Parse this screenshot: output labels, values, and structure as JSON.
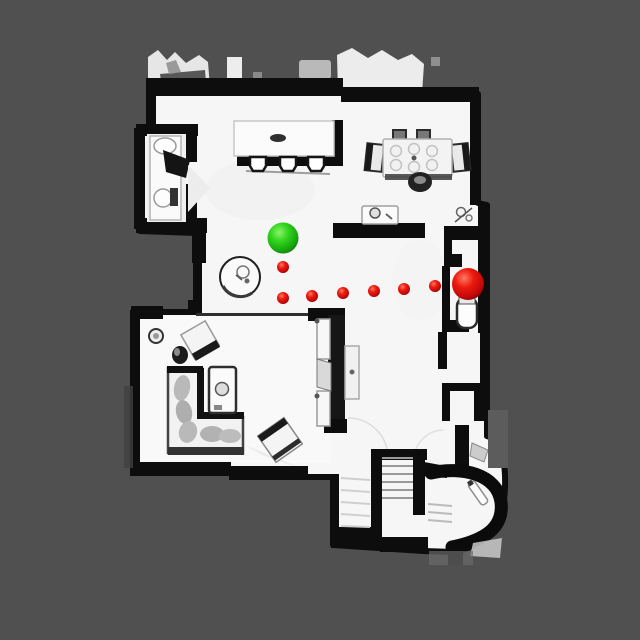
{
  "view": {
    "type": "topdown-floorplan-navigation",
    "canvas_width": 640,
    "canvas_height": 640
  },
  "palette": {
    "background": "#505050",
    "floor": "#f6f6f6",
    "walls": "#0d0d0d",
    "start_green": {
      "highlight": "#8cf26b",
      "base": "#31d41c",
      "dark": "#17a40e",
      "rim": "#0c7a07"
    },
    "goal_red": {
      "highlight": "#ff7a5e",
      "base": "#ec1a10",
      "dark": "#c20808",
      "rim": "#7c0202"
    }
  },
  "navigation": {
    "start": {
      "label": "start",
      "color": "#31d41c",
      "x": 283,
      "y": 238,
      "radius": 15.5
    },
    "goal": {
      "label": "goal",
      "color": "#ec1a10",
      "x": 468,
      "y": 284,
      "radius": 16
    },
    "waypoints": {
      "color": "#ec1a10",
      "radius": 6,
      "points": [
        [
          283,
          267
        ],
        [
          283,
          298
        ],
        [
          312,
          296
        ],
        [
          343,
          293
        ],
        [
          374,
          291
        ],
        [
          404,
          289
        ],
        [
          435,
          286
        ]
      ]
    }
  },
  "rooms": [
    {
      "name": "kitchen",
      "furniture": [
        "kitchen-island",
        "bar-stool",
        "bar-stool",
        "bar-stool",
        "sideboard",
        "side-table"
      ]
    },
    {
      "name": "dining-area",
      "furniture": [
        "dining-table",
        "dining-chair",
        "dining-chair",
        "dining-chair",
        "dining-chair",
        "dining-chair"
      ]
    },
    {
      "name": "bathroom",
      "furniture": [
        "vanity",
        "sink",
        "toilet"
      ]
    },
    {
      "name": "living-room",
      "furniture": [
        "sectional-sofa",
        "coffee-table",
        "accent-chair",
        "armchair",
        "floor-lamp",
        "side-stool",
        "round-table",
        "tv-wall",
        "media-console"
      ]
    },
    {
      "name": "hallway",
      "furniture": [
        "powder-room-toilet",
        "doorway"
      ]
    },
    {
      "name": "entry",
      "furniture": [
        "staircase",
        "curved-wall"
      ]
    }
  ]
}
